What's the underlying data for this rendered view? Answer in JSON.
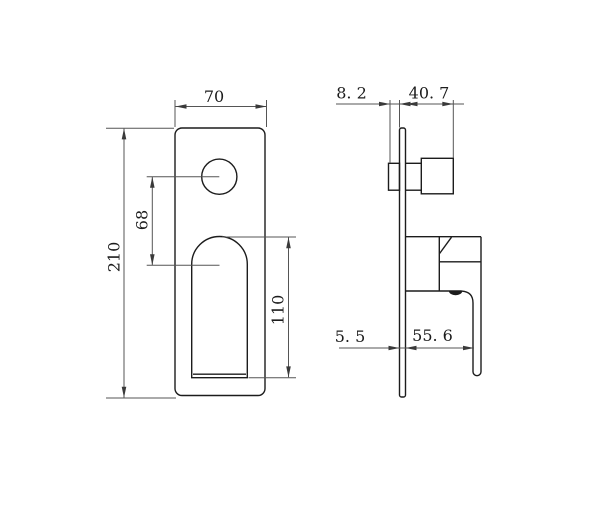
{
  "colors": {
    "background": "#ffffff",
    "object_line": "#1c1c1c",
    "dimension_line": "#555555",
    "label_text": "#1c1c1c"
  },
  "front_view": {
    "width_label": "70",
    "height_label": "210",
    "hole_offset_label": "68",
    "handle_cutout_label": "110"
  },
  "side_view": {
    "body_setback_label": "8. 2",
    "knob_projection_label": "40. 7",
    "plate_thickness_label": "5. 5",
    "handle_projection_label": "55. 6"
  }
}
